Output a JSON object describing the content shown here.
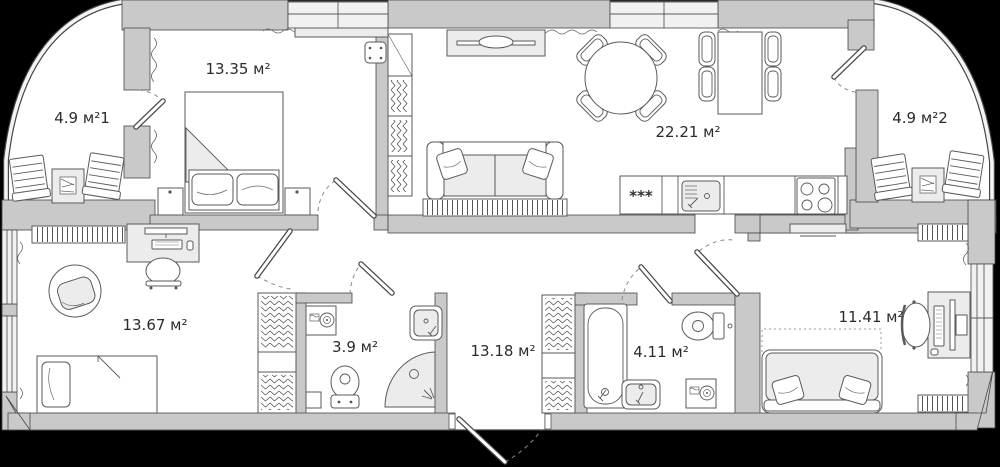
{
  "plan": {
    "type": "apartment-floor-plan",
    "area_unit": "м²",
    "rooms": [
      {
        "name": "balcony-1",
        "label": "4.9 м²1",
        "area": 4.9
      },
      {
        "name": "bedroom-1",
        "label": "13.35 м²",
        "area": 13.35
      },
      {
        "name": "living-kitchen",
        "label": "22.21 м²",
        "area": 22.21
      },
      {
        "name": "balcony-2",
        "label": "4.9 м²2",
        "area": 4.9
      },
      {
        "name": "bedroom-2",
        "label": "13.67 м²",
        "area": 13.67
      },
      {
        "name": "bathroom-1",
        "label": "3.9 м²",
        "area": 3.9
      },
      {
        "name": "hallway",
        "label": "13.18 м²",
        "area": 13.18
      },
      {
        "name": "bathroom-2",
        "label": "4.11 м²",
        "area": 4.11
      },
      {
        "name": "bedroom-3",
        "label": "11.41 м²",
        "area": 11.41
      }
    ],
    "kitchen": {
      "freezer_symbol": "***"
    },
    "colors": {
      "background": "#000000",
      "wall": "#c9c9c9",
      "window": "#f1f1f1",
      "floor": "#ffffff",
      "outline": "#474747",
      "furniture_accent": "#ececec",
      "label_text": "#2b2b2b"
    }
  }
}
